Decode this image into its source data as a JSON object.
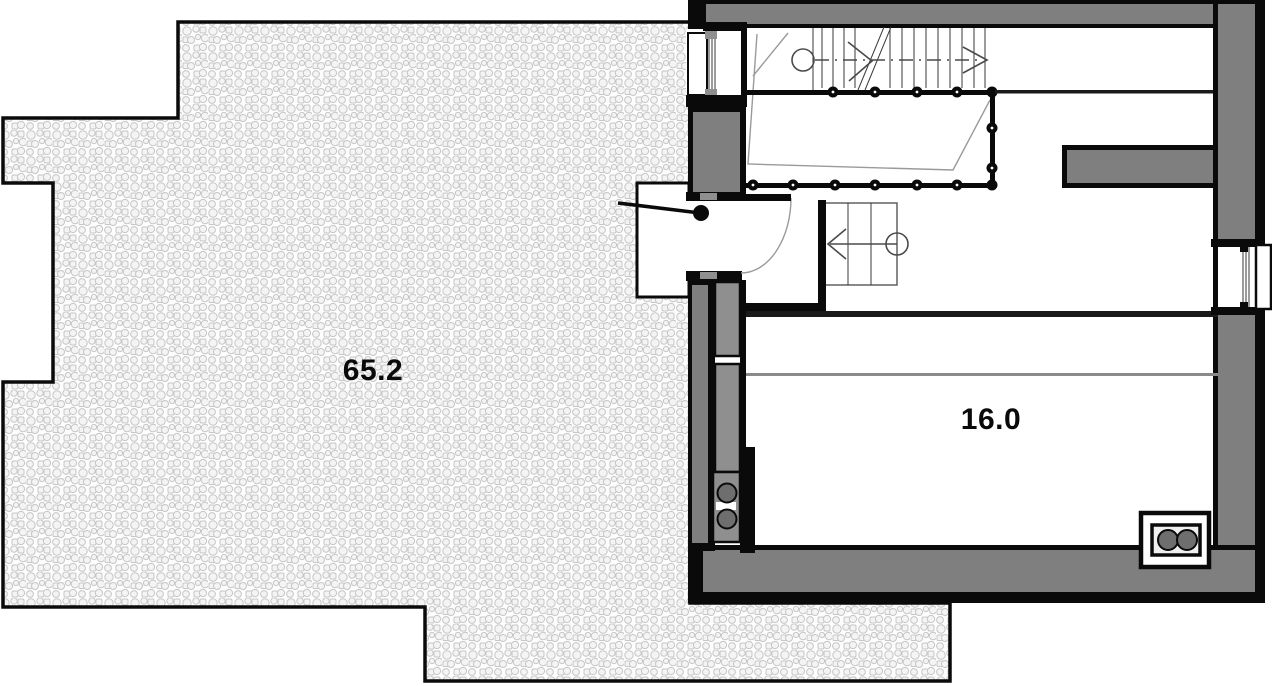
{
  "plan": {
    "title": "attic floor plan",
    "terrace": {
      "area_label": "65.2"
    },
    "room": {
      "area_label": "16.0"
    }
  },
  "colors": {
    "wall-black": "#0a0a0a",
    "wall-gray": "#7f7f7f",
    "cabinet-gray": "#8f8f8f",
    "fixture-dark": "#6e6e6e",
    "texture-line": "#c6c6c6",
    "background": "#ffffff"
  }
}
